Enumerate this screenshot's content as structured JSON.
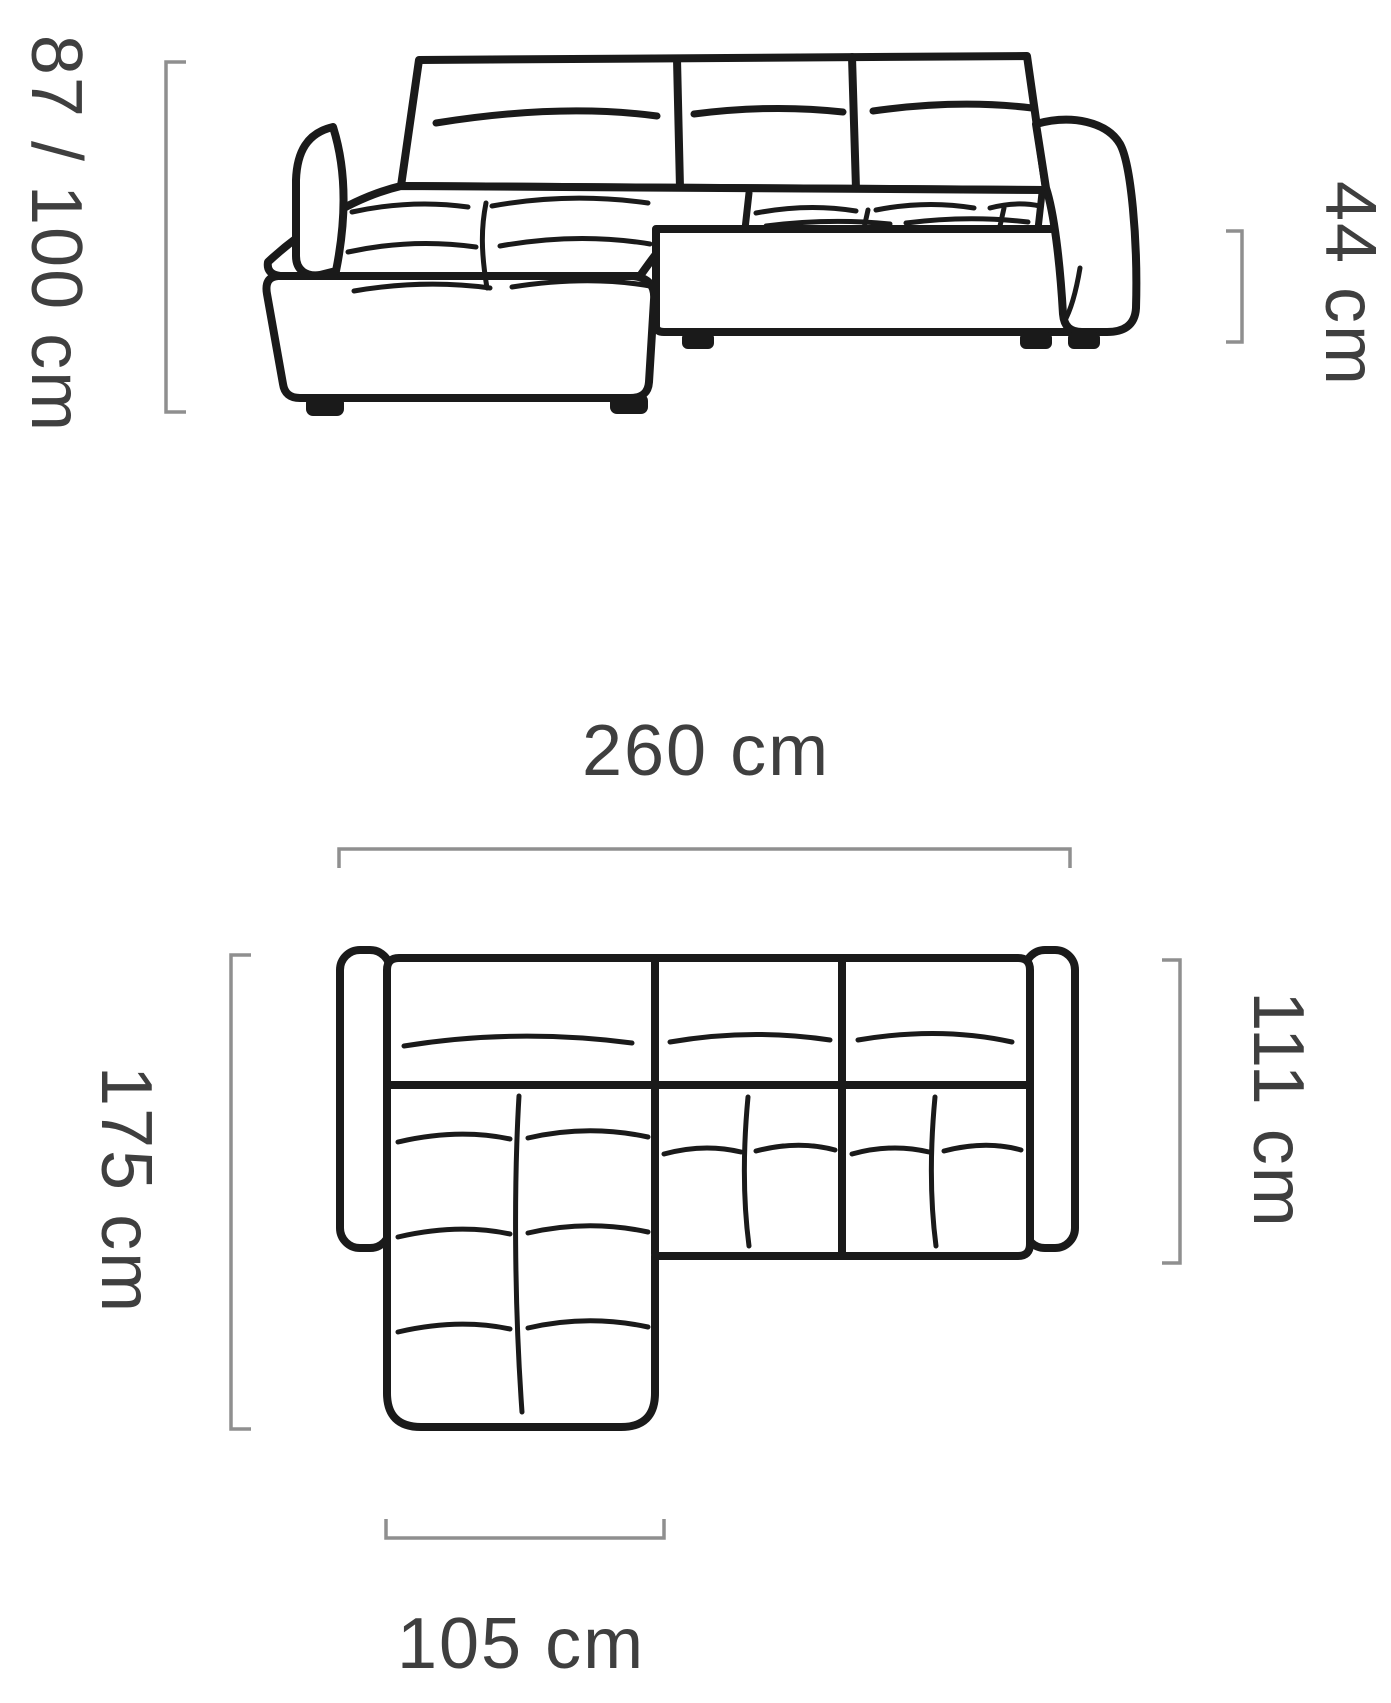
{
  "diagram": {
    "subject": "corner-sofa-dimension-diagram",
    "views": [
      {
        "id": "front-view"
      },
      {
        "id": "top-view"
      }
    ],
    "dimensions": [
      {
        "id": "overall-height",
        "label": "87 / 100 cm",
        "view": "front-view",
        "orientation": "vertical"
      },
      {
        "id": "seat-height",
        "label": "44 cm",
        "view": "front-view",
        "orientation": "vertical"
      },
      {
        "id": "overall-width",
        "label": "260 cm",
        "view": "top-view",
        "orientation": "horizontal"
      },
      {
        "id": "overall-depth",
        "label": "175 cm",
        "view": "top-view",
        "orientation": "vertical"
      },
      {
        "id": "body-depth",
        "label": "111 cm",
        "view": "top-view",
        "orientation": "vertical"
      },
      {
        "id": "chaise-width",
        "label": "105 cm",
        "view": "top-view",
        "orientation": "horizontal"
      }
    ],
    "colors": {
      "line": "#1a1a1a",
      "bracket": "#8f8f8f",
      "text": "#3f3f3f",
      "background": "#ffffff"
    }
  }
}
